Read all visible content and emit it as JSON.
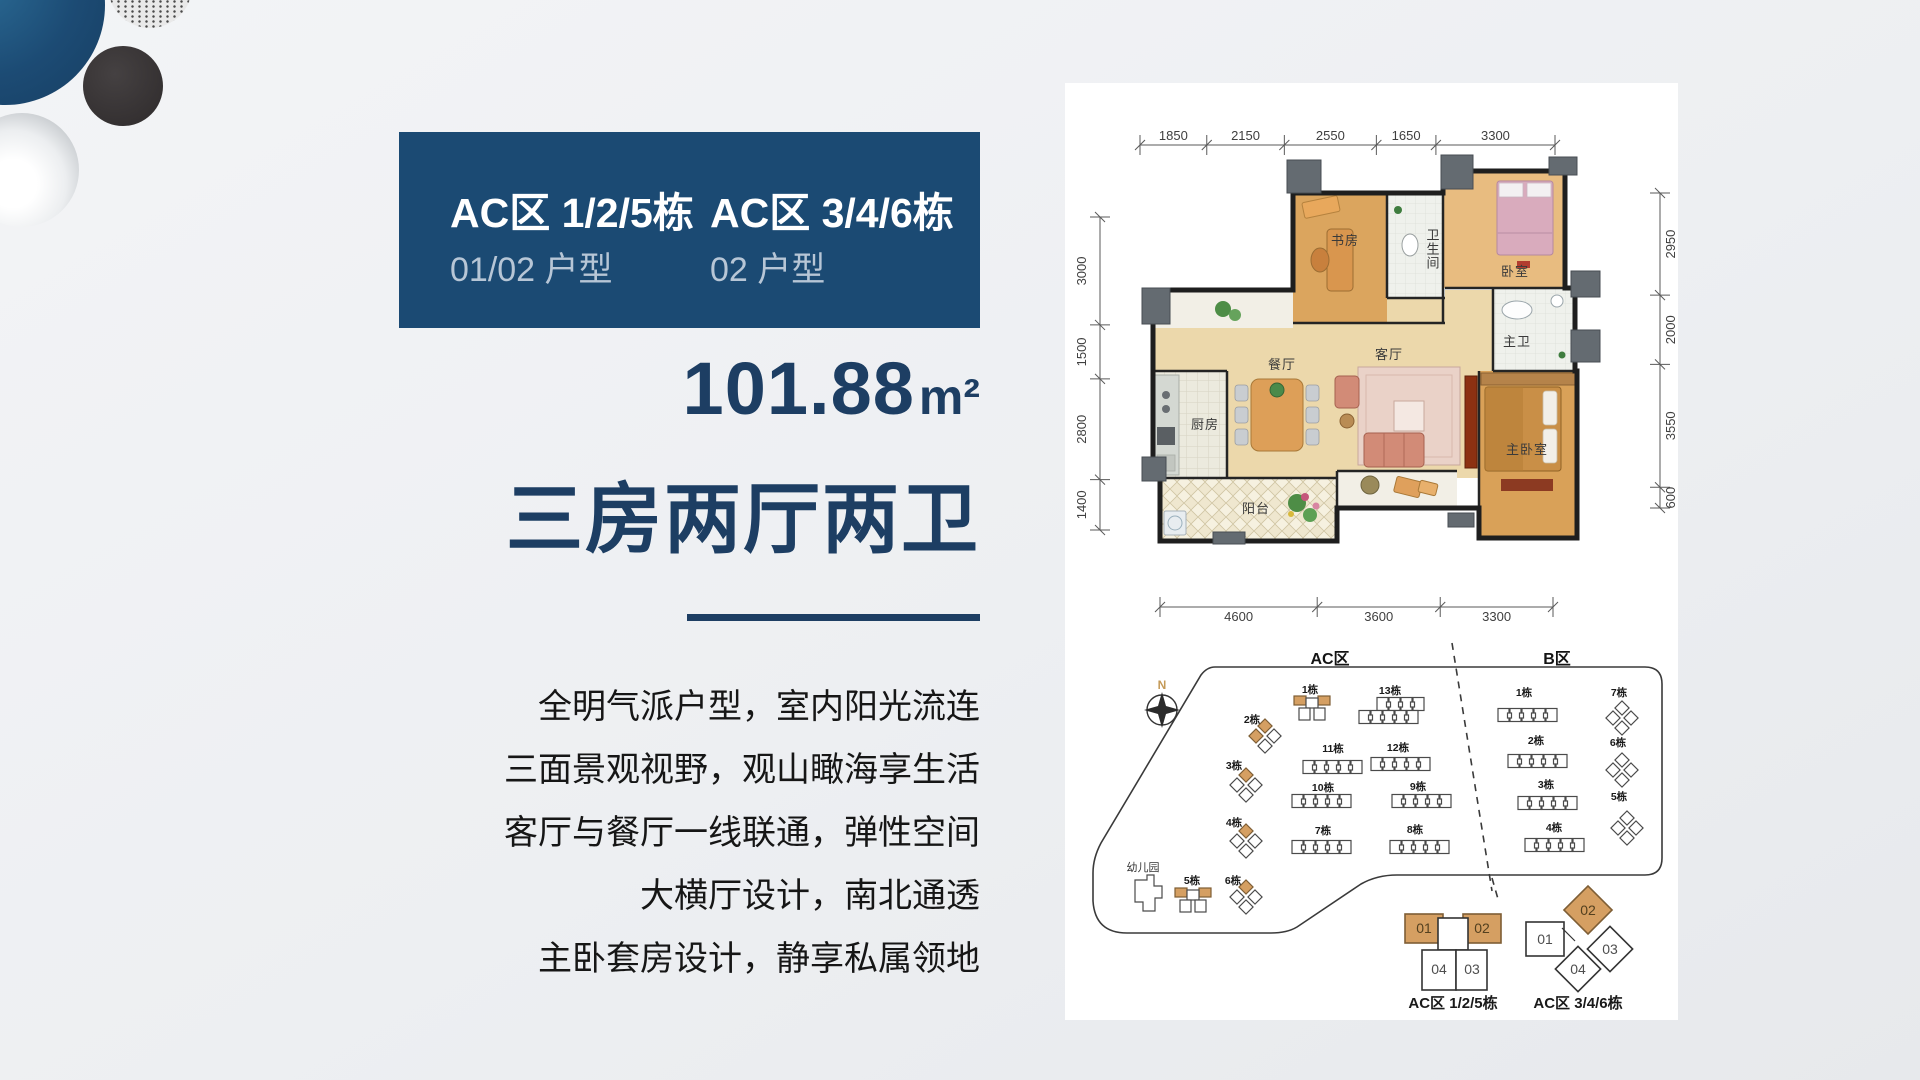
{
  "header_card": {
    "columns": [
      {
        "title": "AC区 1/2/5栋",
        "subtitle": "01/02 户型"
      },
      {
        "title": "AC区 3/4/6栋",
        "subtitle": "02 户型"
      }
    ]
  },
  "area": {
    "value": "101.88",
    "unit": "m²"
  },
  "headline": "三房两厅两卫",
  "description": [
    "全明气派户型，室内阳光流连",
    "三面景观视野，观山瞰海享生活",
    "客厅与餐厅一线联通，弹性空间",
    "大横厅设计，南北通透",
    "主卧套房设计，静享私属领地"
  ],
  "floorplan": {
    "dims_top": [
      "1850",
      "2150",
      "2550",
      "1650",
      "3300"
    ],
    "dims_left": [
      "3000",
      "1500",
      "2800",
      "1400"
    ],
    "dims_right": [
      "2950",
      "2000",
      "3550",
      "600"
    ],
    "dims_bottom": [
      "4600",
      "3600",
      "3300"
    ],
    "rooms": {
      "study": "书房",
      "bath": "卫生间",
      "bedroom": "卧室",
      "master_bath": "主卫",
      "dining": "餐厅",
      "living": "客厅",
      "kitchen": "厨房",
      "balcony": "阳台",
      "master_bedroom": "主卧室"
    }
  },
  "siteplan": {
    "zones": [
      "AC区",
      "B区"
    ],
    "compass": "N",
    "kindergarten": "幼儿园",
    "ac_buildings": [
      {
        "label": "1栋",
        "type": "cross",
        "highlight": 2
      },
      {
        "label": "2栋",
        "type": "pinwheel",
        "highlight": 2
      },
      {
        "label": "3栋",
        "type": "pinwheel",
        "highlight": 1
      },
      {
        "label": "4栋",
        "type": "pinwheel",
        "highlight": 1
      },
      {
        "label": "5栋",
        "type": "cross",
        "highlight": 2
      },
      {
        "label": "6栋",
        "type": "pinwheel",
        "highlight": 1
      },
      {
        "label": "7栋",
        "type": "row"
      },
      {
        "label": "8栋",
        "type": "row"
      },
      {
        "label": "9栋",
        "type": "row"
      },
      {
        "label": "10栋",
        "type": "row"
      },
      {
        "label": "11栋",
        "type": "row"
      },
      {
        "label": "12栋",
        "type": "row"
      },
      {
        "label": "13栋",
        "type": "row-double"
      }
    ],
    "b_buildings": [
      {
        "label": "1栋",
        "type": "row"
      },
      {
        "label": "2栋",
        "type": "row"
      },
      {
        "label": "3栋",
        "type": "row"
      },
      {
        "label": "4栋",
        "type": "row"
      },
      {
        "label": "5栋",
        "type": "pinwheel",
        "highlight": 0
      },
      {
        "label": "6栋",
        "type": "pinwheel",
        "highlight": 0
      },
      {
        "label": "7栋",
        "type": "pinwheel",
        "highlight": 0
      }
    ]
  },
  "legend": [
    {
      "label": "AC区 1/2/5栋",
      "units": [
        "01",
        "02",
        "04",
        "03"
      ]
    },
    {
      "label": "AC区 3/4/6栋",
      "units": [
        "01",
        "02",
        "03",
        "04"
      ]
    }
  ],
  "colors": {
    "card_blue": "#1b4a73",
    "accent_navy": "#1d3e63",
    "card_subtitle": "#b7c6d6",
    "highlight_orange": "#d59f62"
  }
}
